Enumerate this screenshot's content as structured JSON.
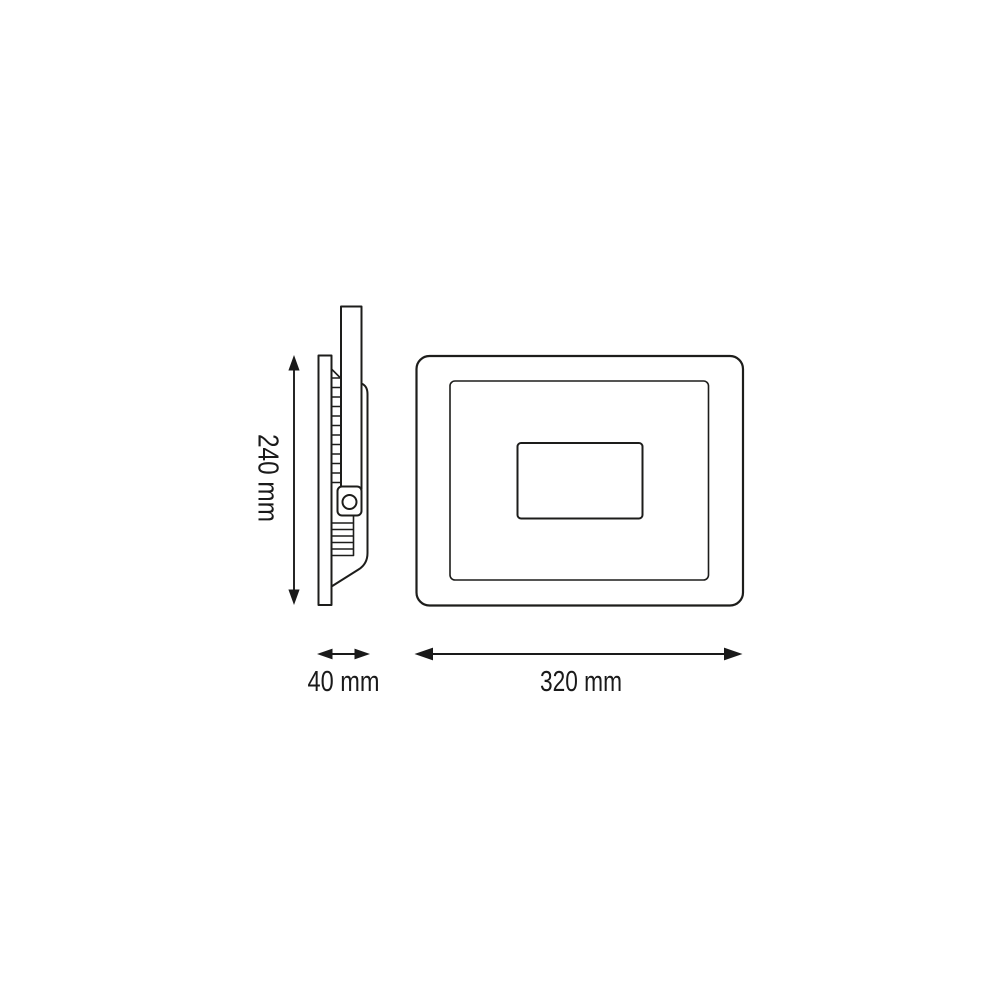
{
  "page": {
    "background_color": "#ffffff",
    "line_color": "#1d1d1b",
    "text_color": "#1a1a1a"
  },
  "diagram": {
    "type": "technical-dimension-drawing",
    "units": "mm",
    "dimensions": {
      "height": {
        "label": "240 mm",
        "value": 240,
        "orientation": "vertical"
      },
      "depth": {
        "label": "40 mm",
        "value": 40,
        "orientation": "horizontal"
      },
      "width": {
        "label": "320 mm",
        "value": 320,
        "orientation": "horizontal"
      }
    }
  }
}
